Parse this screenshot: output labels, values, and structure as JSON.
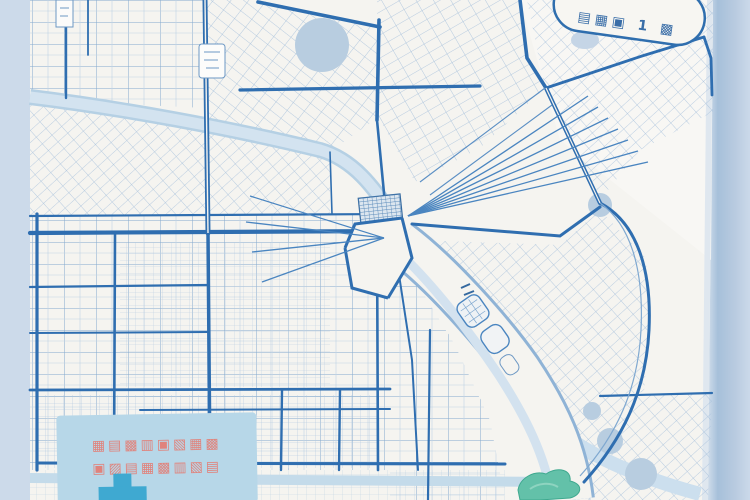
{
  "artwork": {
    "description_visible_elements": {
      "banner": {
        "label": "▤▦▣ 1 ▩"
      },
      "legend_panel": {
        "line1": "▦▤▩▥▣▧▦▩",
        "line2": "▣▨▤▦▩▥▧▤",
        "icon": "medical-cross-icon"
      }
    }
  },
  "colors": {
    "desk_left": "#ccdaea",
    "paper": "#f5f4f0",
    "paper_light": "#f8f7f4",
    "road_bold": "#2f6eb0",
    "road_mid": "#4a85c0",
    "road_light": "#7fa8d0",
    "fine_line": "#a3bedb",
    "river": "#d3e3f0",
    "river_edge": "#b5d0e4",
    "pond": "#b8cde0",
    "park": "#63c1a9",
    "banner_fill": "#f7f6f2",
    "banner_border": "#2f6eae",
    "banner_text": "#3a6ea8",
    "legend_panel": "#b7d7e8",
    "legend_text": "#e0837c",
    "cross": "#3fa9d1"
  }
}
